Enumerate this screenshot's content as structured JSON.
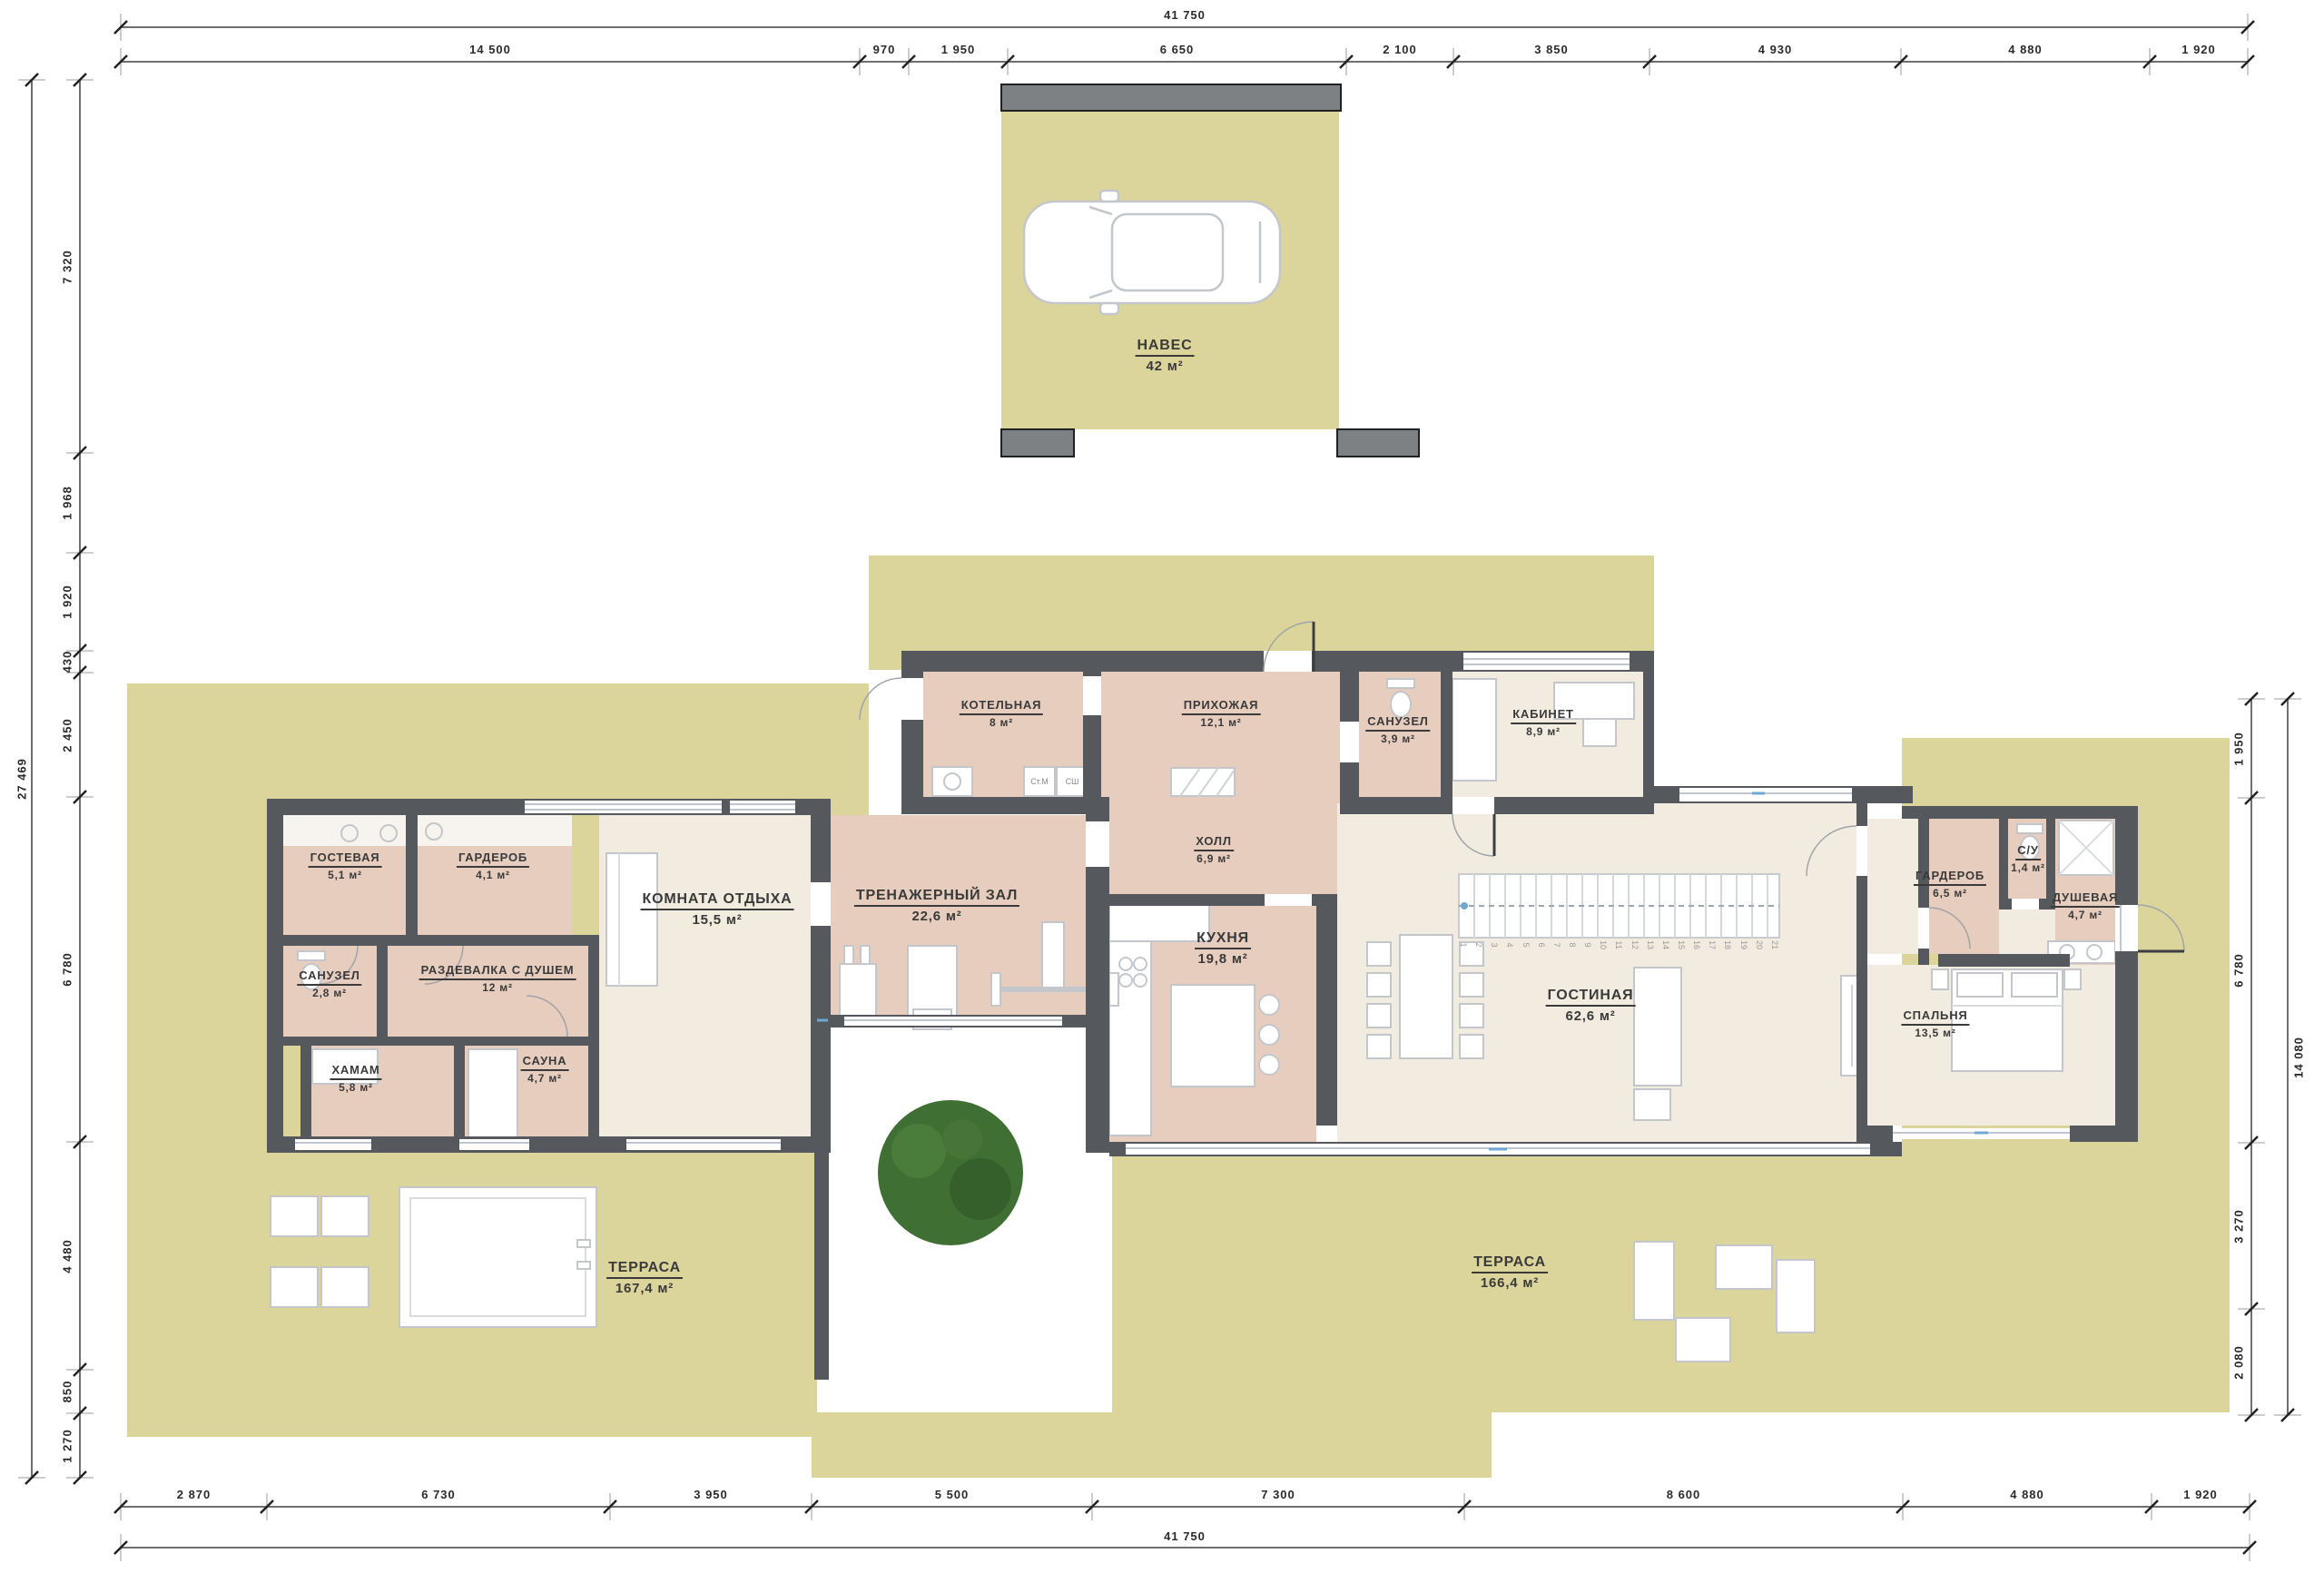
{
  "plan_type": "floor-plan",
  "rooms": [
    {
      "name": "ГОСТЕВАЯ",
      "area": "5,1 м²"
    },
    {
      "name": "ГАРДЕРОБ",
      "area": "4,1 м²"
    },
    {
      "name": "САНУЗЕЛ",
      "area": "2,8 м²"
    },
    {
      "name": "РАЗДЕВАЛКА С ДУШЕМ",
      "area": "12 м²"
    },
    {
      "name": "ХАМАМ",
      "area": "5,8 м²"
    },
    {
      "name": "САУНА",
      "area": "4,7 м²"
    },
    {
      "name": "КОМНАТА ОТДЫХА",
      "area": "15,5 м²"
    },
    {
      "name": "ТРЕНАЖЕРНЫЙ ЗАЛ",
      "area": "22,6 м²"
    },
    {
      "name": "КОТЕЛЬНАЯ",
      "area": "8 м²"
    },
    {
      "name": "ПРИХОЖАЯ",
      "area": "12,1 м²"
    },
    {
      "name": "САНУЗЕЛ",
      "area": "3,9 м²"
    },
    {
      "name": "КАБИНЕТ",
      "area": "8,9 м²"
    },
    {
      "name": "ХОЛЛ",
      "area": "6,9 м²"
    },
    {
      "name": "КУХНЯ",
      "area": "19,8 м²"
    },
    {
      "name": "ГОСТИНАЯ",
      "area": "62,6 м²"
    },
    {
      "name": "ГАРДЕРОБ",
      "area": "6,5 м²"
    },
    {
      "name": "С/У",
      "area": "1,4 м²"
    },
    {
      "name": "ДУШЕВАЯ",
      "area": "4,7 м²"
    },
    {
      "name": "СПАЛЬНЯ",
      "area": "13,5 м²"
    }
  ],
  "outdoor": {
    "carport": {
      "name": "НАВЕС",
      "area": "42 м²"
    },
    "terrace_left": {
      "name": "ТЕРРАСА",
      "area": "167,4 м²"
    },
    "terrace_right": {
      "name": "ТЕРРАСА",
      "area": "166,4 м²"
    }
  },
  "appliances": {
    "washer": "Ст.М",
    "dryer": "СШ"
  },
  "stairs": {
    "steps": [
      "1",
      "2",
      "3",
      "4",
      "5",
      "6",
      "7",
      "8",
      "9",
      "10",
      "11",
      "12",
      "13",
      "14",
      "15",
      "16",
      "17",
      "18",
      "19",
      "20",
      "21"
    ]
  },
  "dims": {
    "top_total": "41 750",
    "top": [
      "14 500",
      "970",
      "1 950",
      "6 650",
      "2 100",
      "3 850",
      "4 930",
      "4 880",
      "1 920"
    ],
    "bottom": [
      "2 870",
      "6 730",
      "3 950",
      "5 500",
      "7 300",
      "8 600",
      "4 880",
      "1 920"
    ],
    "bottom_total": "41 750",
    "left": [
      "7 320",
      "1 968",
      "1 920",
      "430",
      "2 450",
      "6 780",
      "4 480",
      "850",
      "1 270"
    ],
    "left_total": "27 469",
    "right": [
      "1 950",
      "6 780",
      "3 270",
      "2 080"
    ],
    "right_total": "14 080"
  },
  "colors": {
    "terrace": "#dcd59b",
    "room_warm": "#e7cdbe",
    "room_light": "#f1ebe0",
    "wall": "#55585c",
    "post": "#7e8184",
    "tree": "#3f6f33",
    "window_mark": "#6fa8d0"
  }
}
